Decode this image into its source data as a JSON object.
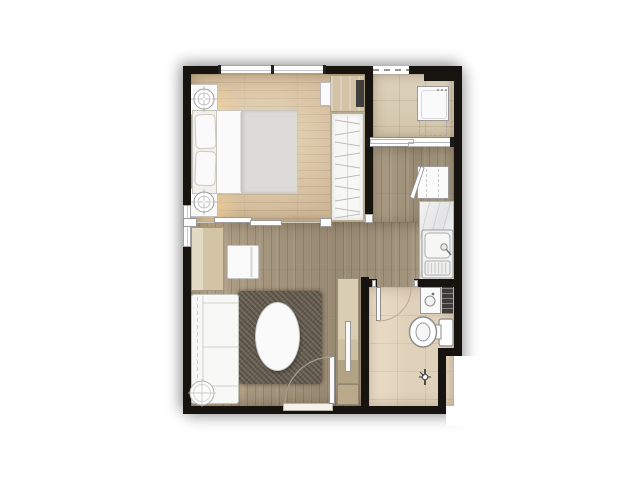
{
  "scene": {
    "kind": "top-down architectural floor plan rendering of a one-bedroom condominium unit",
    "visible_text": "",
    "layout_summary": "bedroom top-left, balcony-laundry top-right, kitchen corridor along right side, living room bottom-left, bathroom bottom-right, entrance door in bottom wall"
  },
  "palette": {
    "background": "#ffffff",
    "wall": "#17130f",
    "bedroom_floor": "#cfb897",
    "living_floor": "#a69780",
    "balcony_floor": "#d8ccb5",
    "bathroom_floor": "#e5d7c1",
    "counter_marble": "#ececee",
    "furniture_white": "#fafafa",
    "furniture_wood": "#d2c3a6",
    "rug": "#6e6456",
    "duvet": "#dcdbd8",
    "tv_dark": "#403e3a",
    "towel_rail_dark": "#3f3c38"
  },
  "rooms": [
    {
      "id": "bedroom",
      "furniture": [
        "double-bed",
        "pillow",
        "pillow",
        "nightstand-with-downlight",
        "nightstand-with-downlight",
        "wardrobe-with-hanging-clothes",
        "dresser-desk",
        "tv-panel",
        "wall-shelf"
      ],
      "openings": [
        "window-top-wall",
        "window-left-wall",
        "sliding-door-to-living"
      ]
    },
    {
      "id": "balcony-laundry",
      "furniture": [
        "washing-machine"
      ],
      "openings": [
        "dashed-open-edge",
        "sliding-window-to-kitchen"
      ]
    },
    {
      "id": "kitchen-corridor",
      "furniture": [
        "refrigerator-with-open-door",
        "marble-counter",
        "kitchen-sink-with-drainboard"
      ],
      "openings": []
    },
    {
      "id": "living-room",
      "furniture": [
        "sofa",
        "round-side-table",
        "shag-rug",
        "oval-coffee-table",
        "chair",
        "sideboard-cabinet",
        "tv-console",
        "tv"
      ],
      "openings": [
        "entrance-door-swing"
      ]
    },
    {
      "id": "bathroom",
      "furniture": [
        "toilet",
        "vanity-basin",
        "towel-rail",
        "shower-mixer"
      ],
      "openings": [
        "door-swing-inward"
      ]
    }
  ],
  "fixtures": {
    "doors": [
      "entrance-door-bottom-wall",
      "bathroom-door",
      "bedroom-sliding-door",
      "balcony-sliding-window"
    ],
    "windows": [
      "bedroom-top-window",
      "bedroom-left-window"
    ],
    "wall_notch": "bathroom lower-right corner steps inward"
  }
}
